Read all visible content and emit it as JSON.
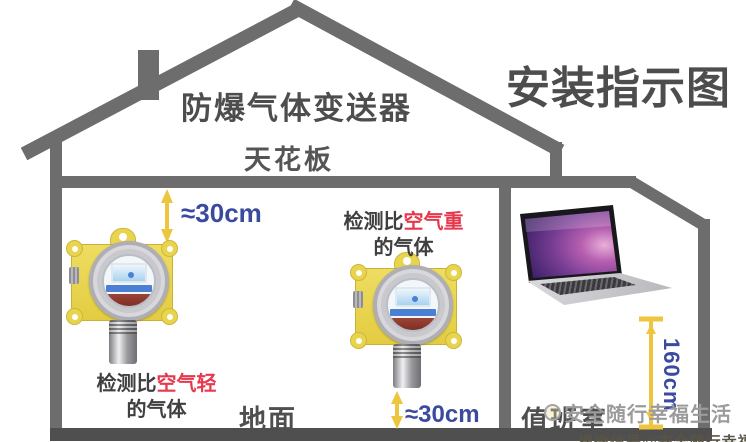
{
  "title": "安装指示图",
  "roof_label": "防爆气体变送器",
  "ceiling_label": "天花板",
  "floor_label": "地面",
  "duty_room_label": "值班室",
  "measurements": {
    "top_gap": "≈30cm",
    "bottom_gap": "≈30cm",
    "duty_room_height": "160cm"
  },
  "annotations": {
    "lighter": {
      "prefix": "检测比",
      "highlight": "空气轻",
      "suffix": "的气体"
    },
    "heavier": {
      "prefix": "检测比",
      "highlight": "空气重",
      "suffix": "的气体"
    }
  },
  "watermark": {
    "text": "安全随行幸福生活",
    "bottom_text": "搜微信号@安全随行幸福生活"
  },
  "icons": {
    "left_device": "gas-detector-icon",
    "middle_device": "gas-detector-icon",
    "right_device": "laptop-icon"
  },
  "colors": {
    "structure_gray": "#6d6d6d",
    "floor_gray": "#4f4f4f",
    "title_gray": "#4d4d4d",
    "accent_blue": "#3a4a9f",
    "accent_red": "#e6394e",
    "arrow_yellow": "#edc53f",
    "detector_yellow": "#e9d44e",
    "watermark_gray": "#9b9b9b"
  }
}
